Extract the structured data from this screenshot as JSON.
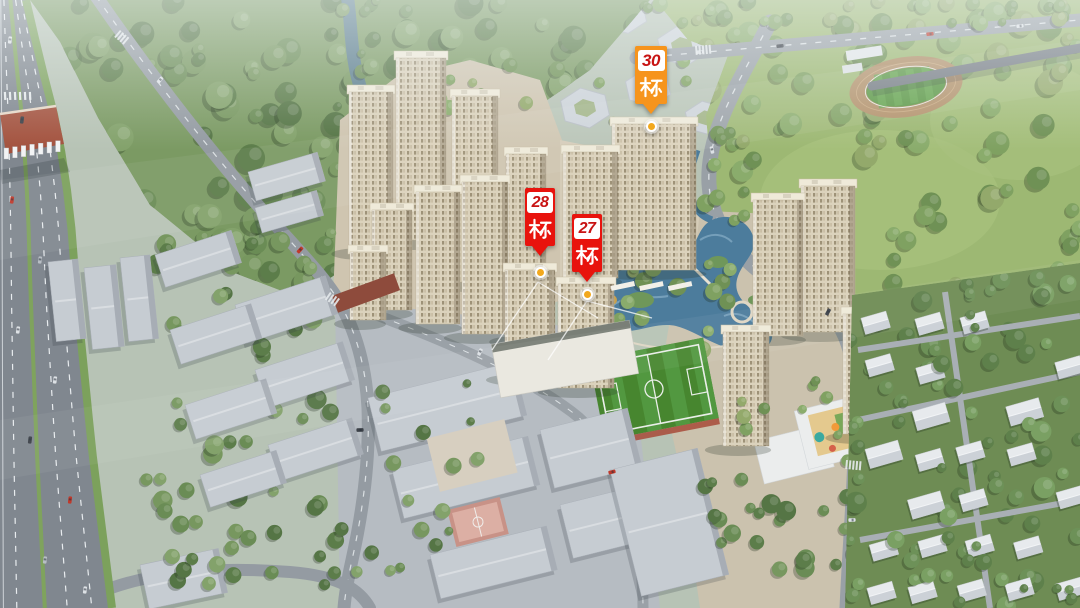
{
  "labels": [
    {
      "id": "building-30",
      "number": "30",
      "suffix": "栋",
      "tag_color": "#F6941D",
      "number_color": "#C81414",
      "text_color": "#FFFFFF"
    },
    {
      "id": "building-28",
      "number": "28",
      "suffix": "栋",
      "tag_color": "#E8130D",
      "number_color": "#C81414",
      "text_color": "#FFFFFF"
    },
    {
      "id": "building-27",
      "number": "27",
      "suffix": "栋",
      "tag_color": "#E8130D",
      "number_color": "#C81414",
      "text_color": "#FFFFFF"
    }
  ],
  "marker": {
    "halo_color": "rgba(255,255,255,0.5)",
    "ring_color": "#FFFFFF",
    "center_color": "#F2A81D"
  },
  "scene": {
    "type": "aerial-3d-render-residential-development",
    "elements": [
      "forest",
      "river",
      "city-park",
      "running-track",
      "football-field",
      "lake",
      "stream",
      "residential-towers",
      "retail-podium",
      "toll-gate",
      "highway",
      "kindergarten-playground",
      "low-rise-neighborhood",
      "massing-blocks",
      "basketball-court"
    ],
    "palette": {
      "water": "#4C7C9C",
      "tree": "#6A8C55",
      "park_grass": "#9CBA74",
      "road": "#8D949B",
      "highway": "#80878F",
      "tower_facade": "#D9D0BA",
      "massing": "#C6CCD2",
      "field_green": "#47862F",
      "track_tan": "#B08E66",
      "toll_roof": "#A3523E"
    }
  }
}
